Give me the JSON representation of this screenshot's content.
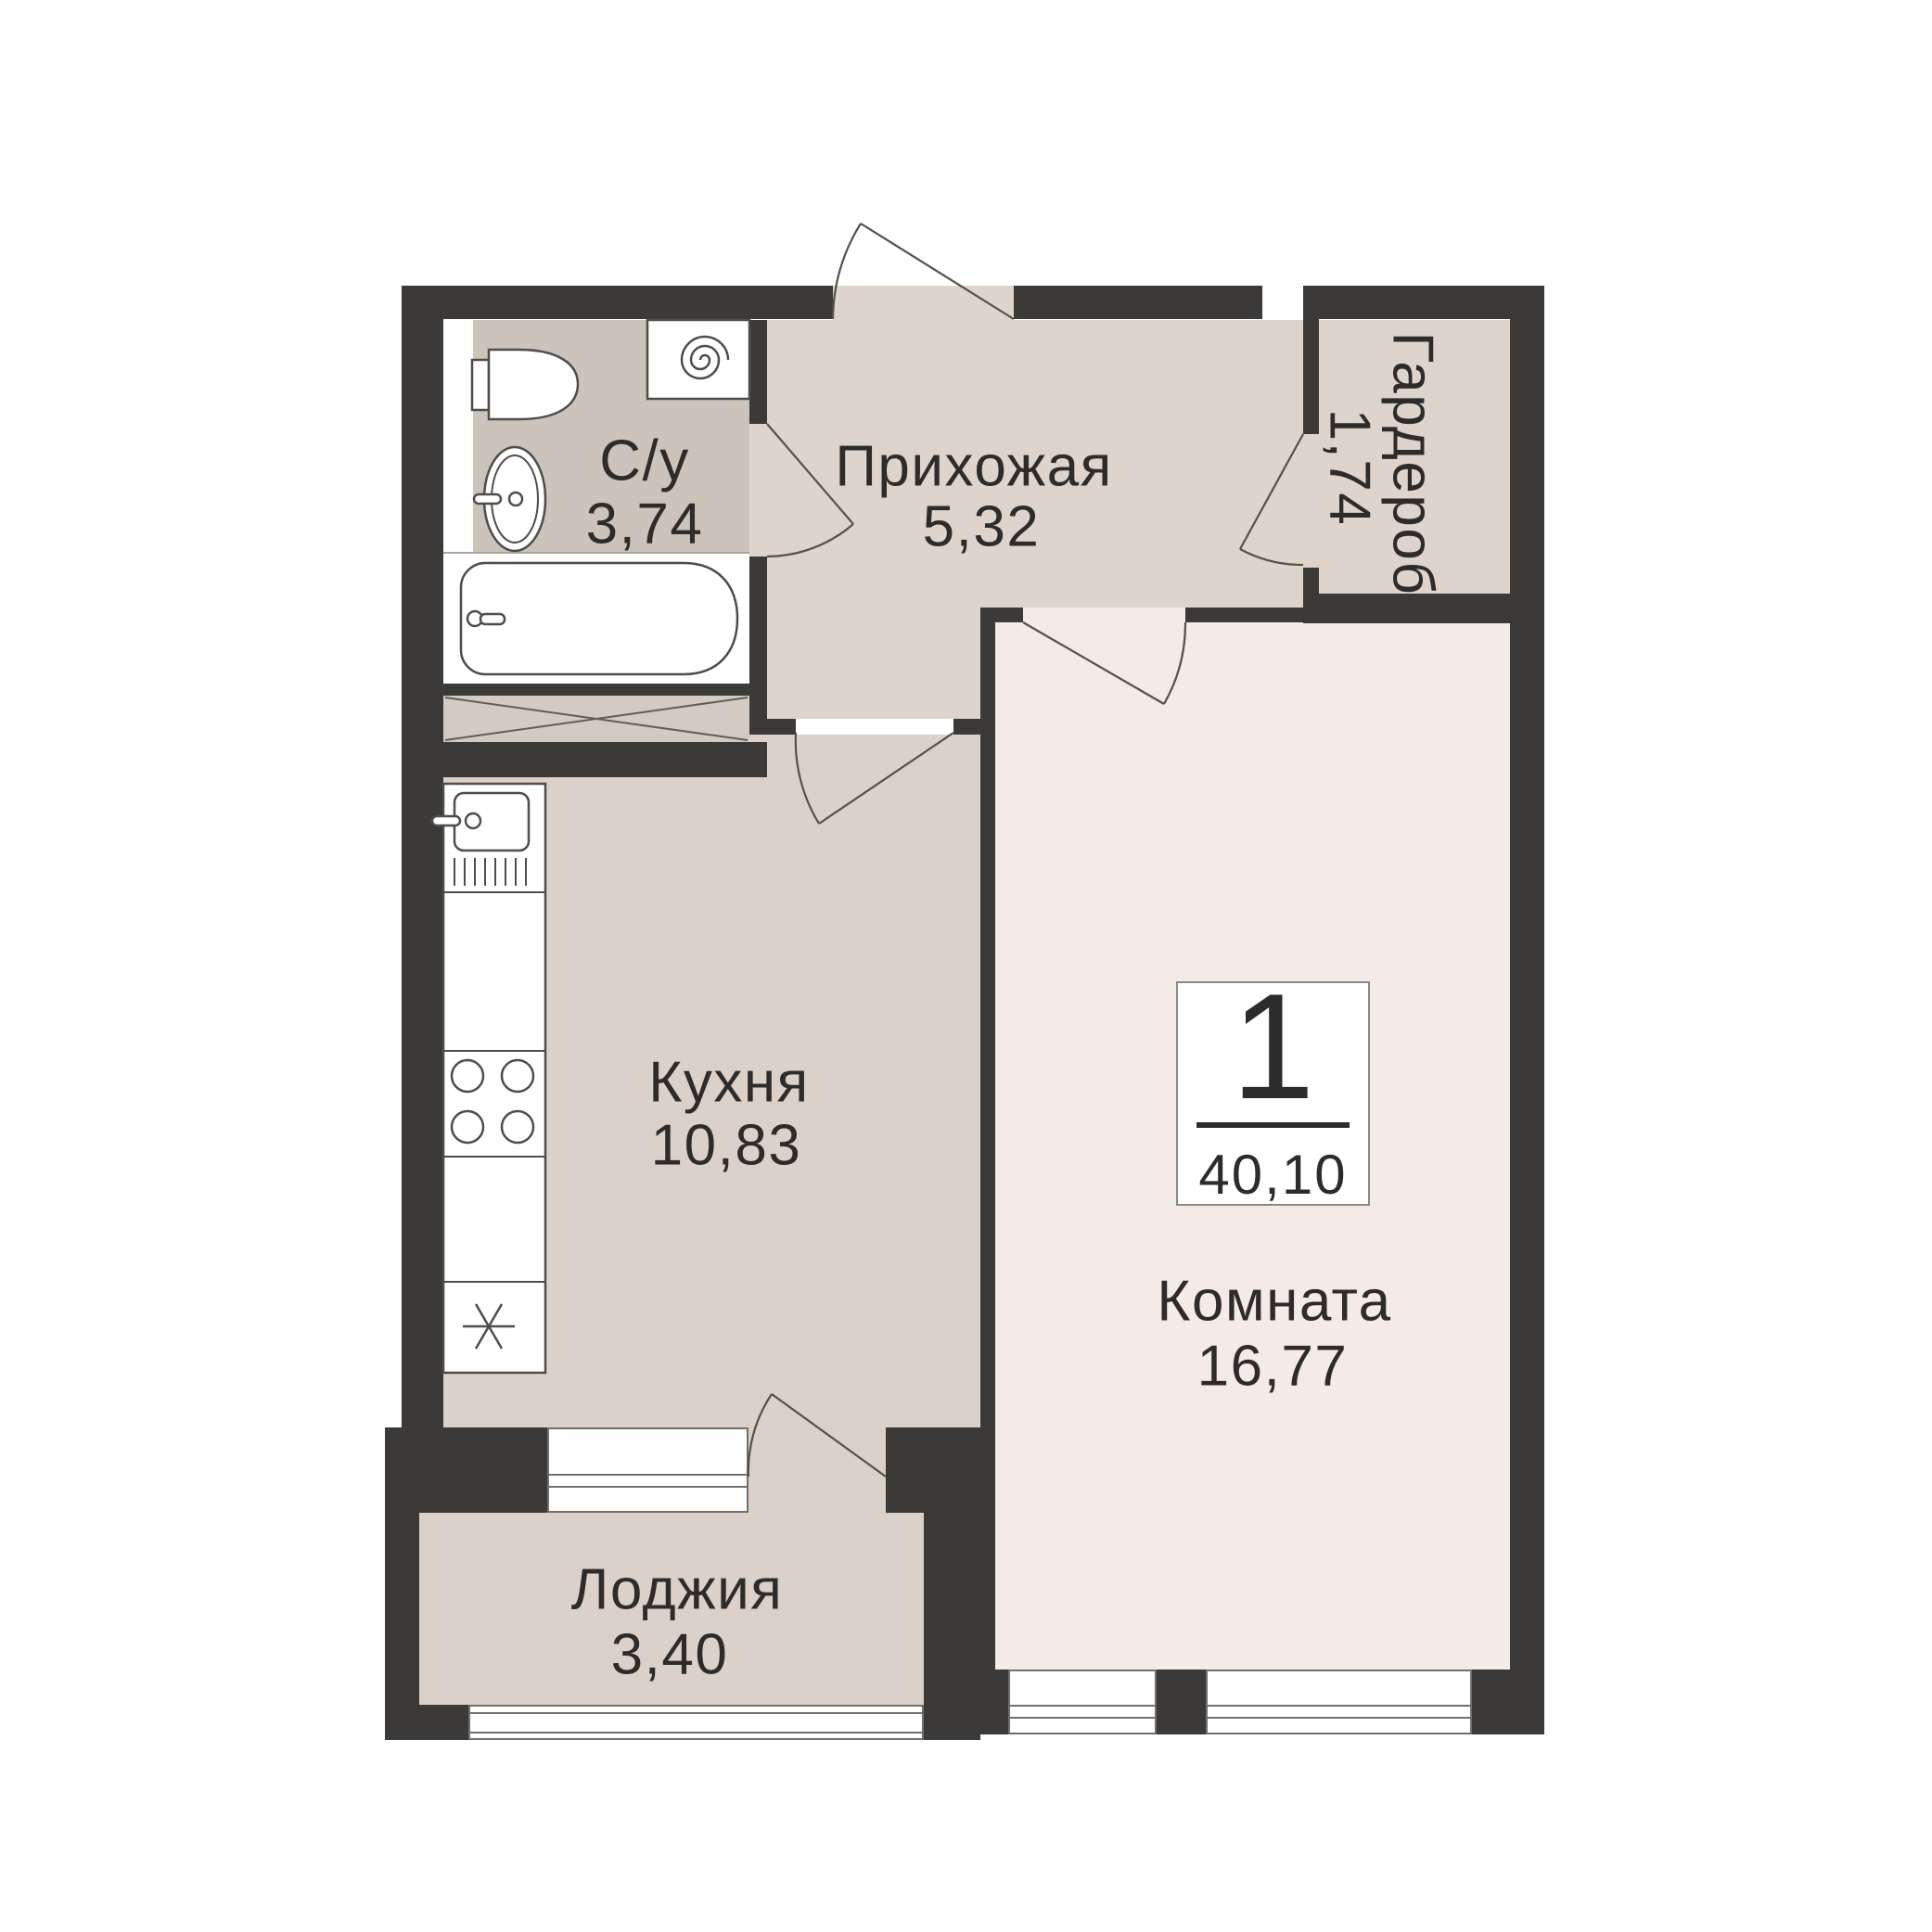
{
  "title": "Floor plan — 1-room apartment 40,10 m²",
  "badge": {
    "rooms_count": "1",
    "total_area": "40,10"
  },
  "rooms": {
    "bathroom": {
      "name": "С/у",
      "area": "3,74"
    },
    "hallway": {
      "name": "Прихожая",
      "area": "5,32"
    },
    "wardrobe": {
      "name": "Гардероб",
      "area": "1,74"
    },
    "kitchen": {
      "name": "Кухня",
      "area": "10,83"
    },
    "living": {
      "name": "Комната",
      "area": "16,77"
    },
    "loggia": {
      "name": "Лоджия",
      "area": "3,40"
    }
  },
  "colors": {
    "wall": "#3b3a38",
    "bathroom_floor": "#ccc4bb",
    "hallway_floor": "#ded4cb",
    "wardrobe_floor": "#ded4cb",
    "kitchen_floor": "#dbd1c8",
    "loggia_floor": "#dbd1c8",
    "living_floor": "#f4eae6",
    "shaft_fill": "#d3cac1",
    "line": "#52514d",
    "text": "#2d2c2a",
    "background": "#ffffff"
  }
}
